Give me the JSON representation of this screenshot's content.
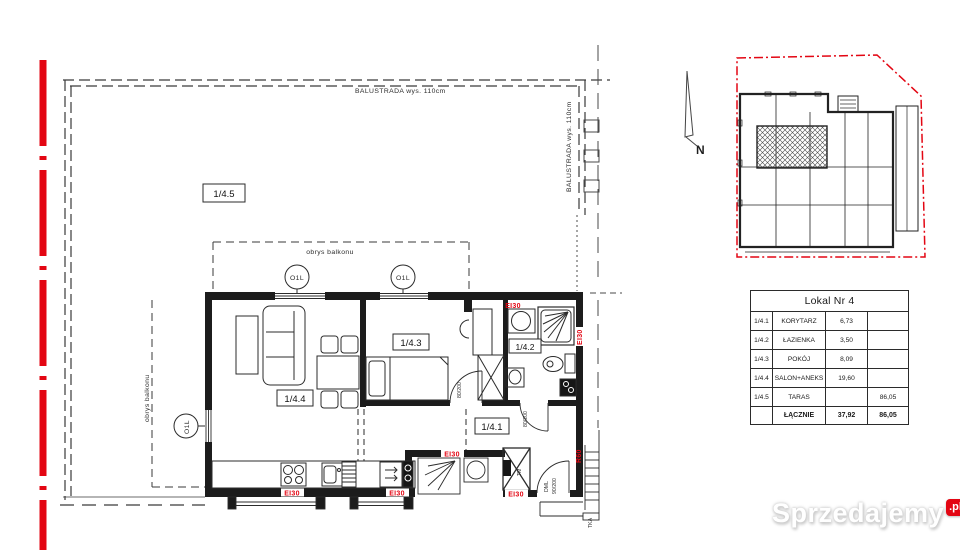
{
  "colors": {
    "boundary_red": "#e30613",
    "line": "#1f1f1f"
  },
  "floor_plan": {
    "terrace_label": "1/4.5",
    "balustrade_top": "BALUSTRADA wys. 110cm",
    "balustrade_right": "BALUSTRADA wys. 110cm",
    "balcony_outline_top": "obrys balkonu",
    "balcony_outline_left": "obrys balkonu",
    "rooms": {
      "salon": "1/4.4",
      "bedroom": "1/4.3",
      "bathroom": "1/4.2",
      "corridor": "1/4.1"
    },
    "window_tag": "O1L",
    "fire_labels": {
      "ei30": "EI30",
      "r60": "R60"
    },
    "doors": {
      "entrance_type": "DML",
      "entrance_size": "90/200",
      "interior_size": "80/200"
    },
    "shaft_label": "TM",
    "stair_label": "TKA"
  },
  "site_plan": {
    "north_label": "N"
  },
  "area_table": {
    "title": "Lokal Nr 4",
    "rows": [
      {
        "no": "1/4.1",
        "name": "KORYTARZ",
        "area": "6,73",
        "area2": ""
      },
      {
        "no": "1/4.2",
        "name": "ŁAZIENKA",
        "area": "3,50",
        "area2": ""
      },
      {
        "no": "1/4.3",
        "name": "POKÓJ",
        "area": "8,09",
        "area2": ""
      },
      {
        "no": "1/4.4",
        "name": "SALON+ANEKS",
        "area": "19,60",
        "area2": ""
      },
      {
        "no": "1/4.5",
        "name": "TARAS",
        "area": "",
        "area2": "86,05"
      }
    ],
    "footer": {
      "label": "ŁĄCZNIE",
      "area": "37,92",
      "area2": "86,05"
    }
  },
  "watermark": {
    "name": "Sprzedajemy",
    "tld": ".pl"
  }
}
